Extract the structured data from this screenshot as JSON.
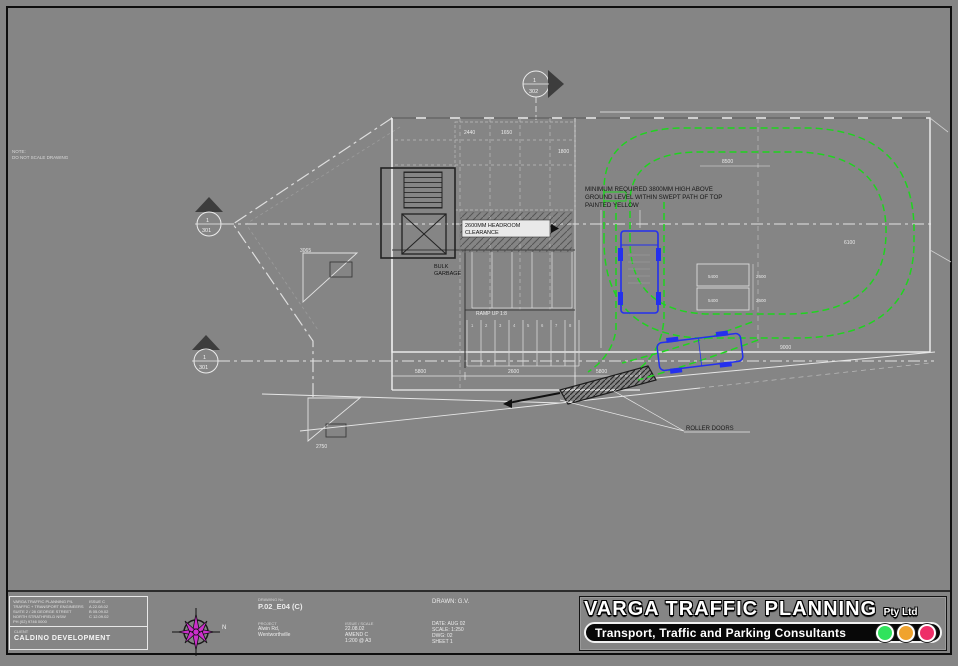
{
  "meta": {
    "sheet_background": "#858585",
    "swept_path_green": "#1fd41f",
    "vehicle_blue": "#2430ee",
    "compass_magenta": "#cc2fcc"
  },
  "title_block": {
    "company": "VARGA TRAFFIC PLANNING",
    "company_suffix": "Pty Ltd",
    "tagline": "Transport, Traffic and Parking Consultants",
    "light_colors": [
      "#30e35c",
      "#f0a32e",
      "#ee2e68"
    ],
    "client_label": "CLIENT",
    "client_name": "CALDINO DEVELOPMENT",
    "contact_lines": [
      "VARGA TRAFFIC PLANNING P/L",
      "TRAFFIC + TRANSPORT ENGINEERS",
      "SUITE 2 / 28 GEORGE STREET",
      "NORTH STRATHFIELD NSW",
      "PH (02) 9746 0000"
    ],
    "issue_lines": [
      "ISSUE C",
      "A  22.08.02",
      "B  05.09.02",
      "C  12.09.02"
    ],
    "drawing_label": "DRAWING No",
    "drawing_value": "P.02_E04 (C)",
    "project_label": "PROJECT",
    "project_lines": [
      "Alwin Rd,",
      "Wentworthville"
    ],
    "issue_label": "ISSUE / SCALE",
    "issue_col": [
      "22.08.02",
      "AMEND C",
      "1:200 @ A3"
    ],
    "drawn_line": "DRAWN: G.V.",
    "meta_col": [
      "DATE: AUG 02",
      "SCALE: 1:250",
      "DWG: 02",
      "SHEET 1"
    ]
  },
  "drawing": {
    "corner_note": [
      "NOTE:",
      "DO NOT SCALE DRAWING"
    ],
    "note": {
      "l1": "MINIMUM REQUIRED 3800MM HIGH ABOVE",
      "l2": "GROUND LEVEL WITHIN SWEPT PATH OF TOP",
      "l3": "PAINTED YELLOW"
    },
    "headroom": [
      "2600MM HEADROOM",
      "CLEARANCE"
    ],
    "bulk_room": [
      "BULK",
      "GARBAGE"
    ],
    "ramp_label": "RAMP UP 1:8",
    "roller_label": "ROLLER DOORS",
    "sections": {
      "top_num": "1",
      "top_sheet": "302",
      "mid_num": "1",
      "mid_sheet": "301",
      "low_num": "1",
      "low_sheet": "301"
    },
    "bay_numbers": [
      "1",
      "2",
      "3",
      "4",
      "5",
      "6",
      "7",
      "8"
    ],
    "dims": [
      "3065",
      "2750",
      "5800",
      "2600",
      "5800",
      "8500",
      "6100",
      "2440",
      "1650",
      "1800",
      "5400",
      "5400",
      "2600",
      "2600",
      "9000"
    ],
    "compass_label": "N"
  }
}
